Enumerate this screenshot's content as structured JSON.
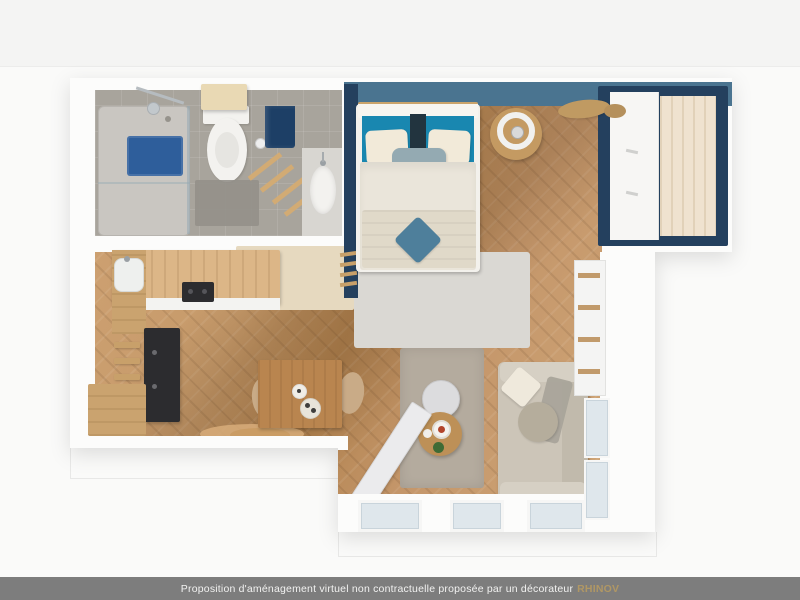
{
  "footer": {
    "message": "Proposition d'aménagement virtuel non contractuelle proposée par un décorateur",
    "brand": "RHINOV"
  },
  "scene": {
    "type": "3d-floorplan-render",
    "rooms": [
      "bathroom",
      "bedroom",
      "kitchen",
      "dining-area",
      "living-room",
      "entry-hall"
    ]
  },
  "palette": {
    "bg": "#f4f4f3",
    "bar": "#7d7d7d",
    "barText": "#f2f2f1",
    "brand": "#b09764",
    "wallWhite": "#fcfcfb",
    "bathFloor": "#a8a49c",
    "bathMat": "#94908a",
    "showerTray": "#c9c6c1",
    "showerMat": "#2e5e9b",
    "towelNavy": "#1d3f66",
    "cabinetBeige": "#e9d9b4",
    "porcelain": "#f3f2ef",
    "steelBlue": "#4a7490",
    "navy": "#24405e",
    "wardrobeWood": "#efe2cf",
    "headboardTeal": "#1987b0",
    "pillowCream": "#f2ead9",
    "lumbar": "#94aab2",
    "duvet": "#eae5da",
    "throwBeige": "#e0d9c9",
    "cushionTeal": "#4e7f9b",
    "bedRug": "#dad8d3",
    "counterWood": "#dcb687",
    "cabinetWood": "#caa36f",
    "appliance": "#2c2c2f",
    "tableWood": "#b9854f",
    "chairBeige": "#c9ab87",
    "cowRug": "#d8ad7a",
    "rug": "#b4ab9e",
    "sofaBase": "#ccc5b8",
    "sofaCushion": "#d6d0c4",
    "pouf": "#b5ad9c",
    "whiteTable": "#dcdcde",
    "trayTable": "#bd9057",
    "shelfWood": "#c19a6b",
    "windowGlass": "#dfe7ec",
    "entryBeige": "#e6d9bf"
  }
}
